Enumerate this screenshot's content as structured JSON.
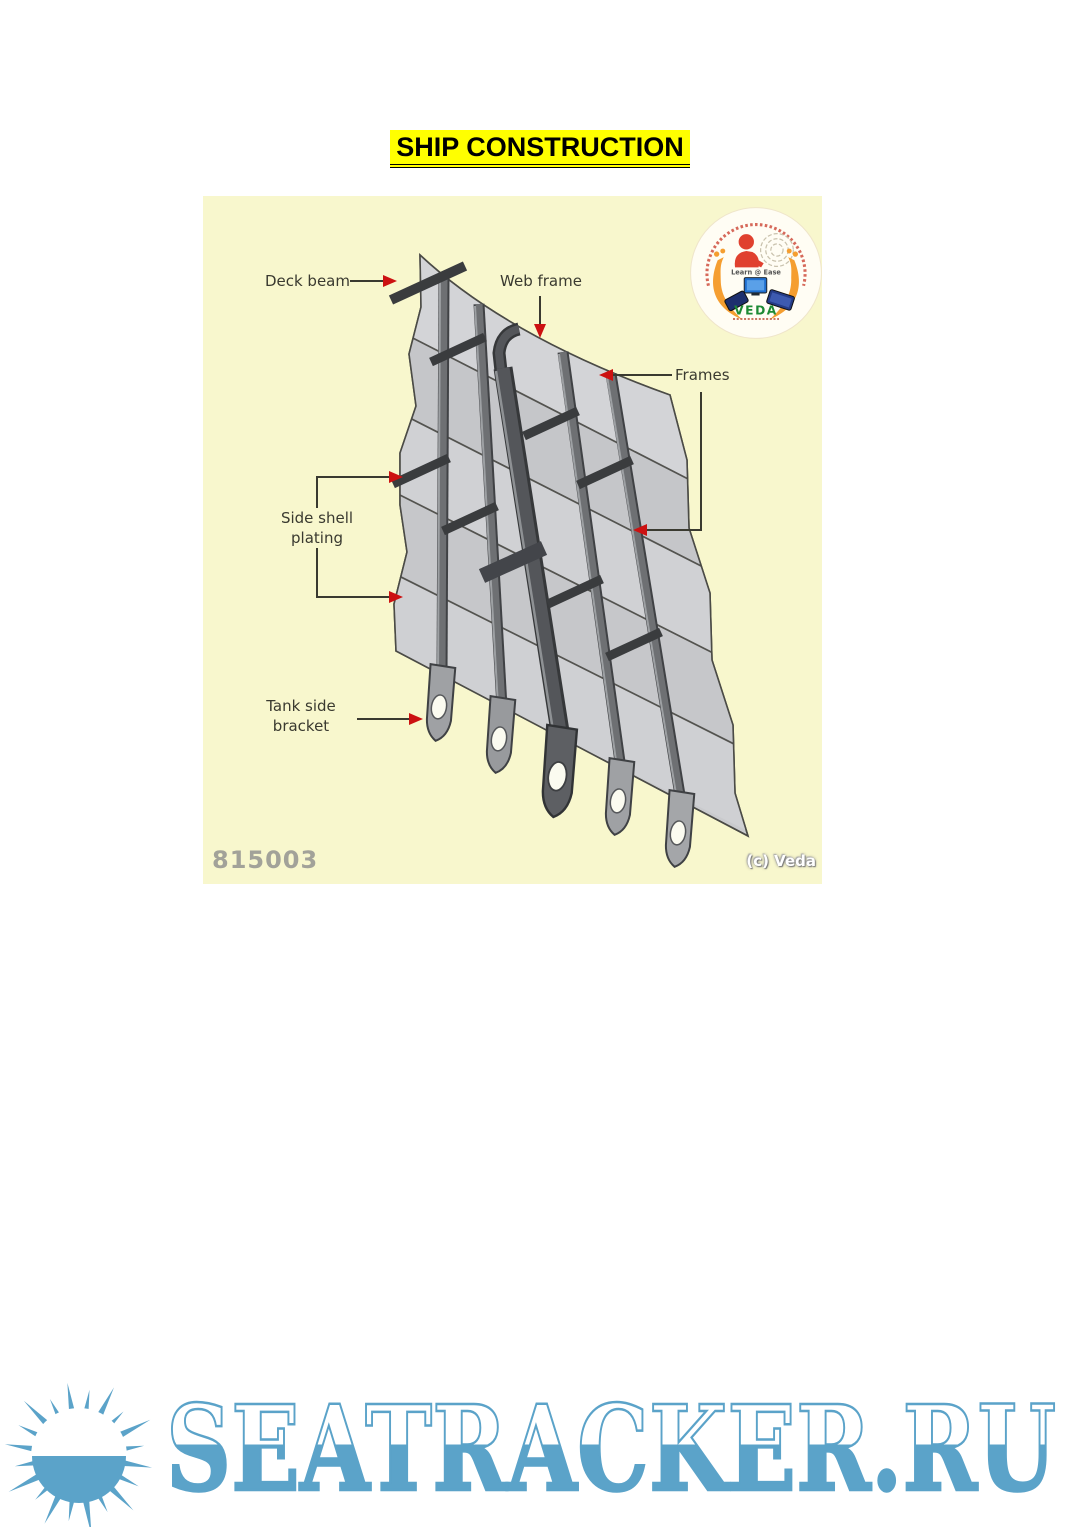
{
  "title": {
    "text": "SHIP CONSTRUCTION",
    "highlight_color": "#ffff00",
    "text_color": "#000000"
  },
  "diagram": {
    "background": "#f8f7cd",
    "figure_number": "815003",
    "copyright": "(c) Veda",
    "labels": {
      "deck_beam": "Deck beam",
      "web_frame": "Web frame",
      "frames": "Frames",
      "side_shell_line1": "Side shell",
      "side_shell_line2": "plating",
      "tank_bracket_line1": "Tank side",
      "tank_bracket_line2": "bracket"
    },
    "colors": {
      "arrow": "#cc1111",
      "leader_line": "#3a3a30",
      "plating": "#cbccce",
      "frame": "#6e7073",
      "label_text": "#3a3a30"
    }
  },
  "logo": {
    "name": "VEDA",
    "tagline": "Learn @ Ease"
  },
  "watermark": {
    "text": "SEATRACKER.RU",
    "color": "#5ba3c9"
  }
}
